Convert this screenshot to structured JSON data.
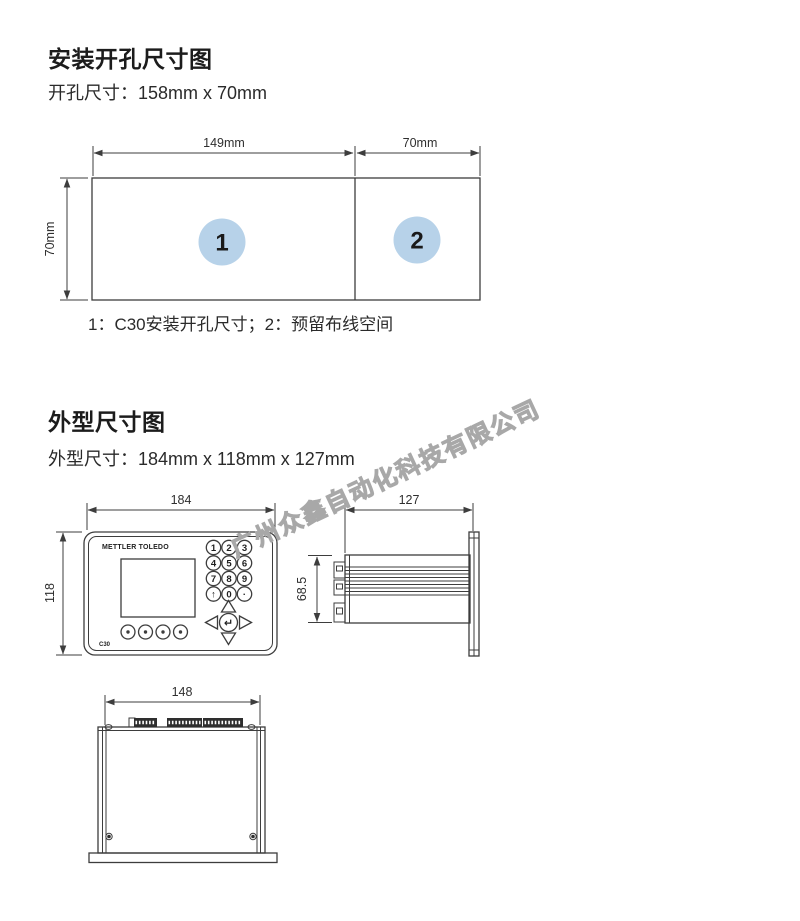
{
  "page": {
    "background": "#ffffff",
    "line_color": "#3d3d3d"
  },
  "cutout": {
    "title": "安装开孔尺寸图",
    "subtitle": "开孔尺寸：158mm x 70mm",
    "dim_width": "149mm",
    "dim_reserve": "70mm",
    "dim_height": "70mm",
    "badge1": "1",
    "badge2": "2",
    "badge_fill": "#b7d2e9",
    "caption": "1：C30安装开孔尺寸；2：预留布线空间"
  },
  "outline": {
    "title": "外型尺寸图",
    "subtitle": "外型尺寸：184mm x 118mm x 127mm",
    "front": {
      "dim_width": "184",
      "dim_height": "118",
      "logo": "METTLER TOLEDO",
      "model": "C30",
      "keys": [
        "1",
        "2",
        "3",
        "4",
        "5",
        "6",
        "7",
        "8",
        "9",
        "↑",
        "0",
        "·"
      ],
      "enter": "↵"
    },
    "side": {
      "dim_depth": "127",
      "dim_body_height": "68.5"
    },
    "bottom": {
      "dim_width": "148"
    }
  },
  "watermark": {
    "text": "广州众鑫自动化科技有限公司",
    "color": "#a8a8a8"
  }
}
